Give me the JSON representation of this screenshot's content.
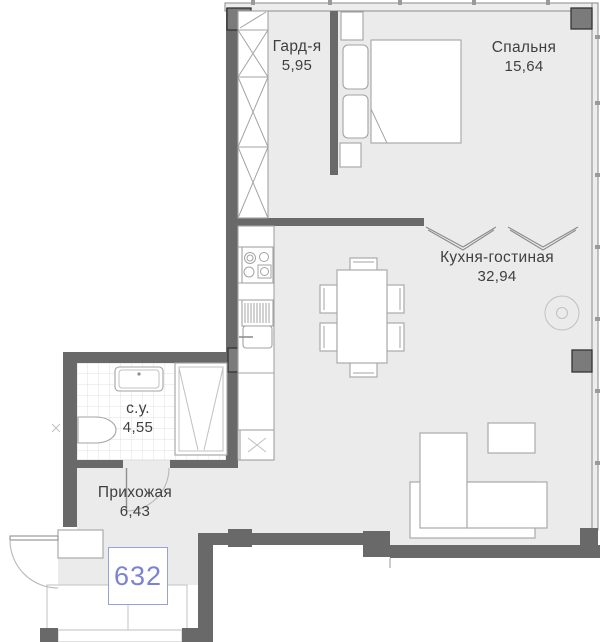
{
  "theme": {
    "floor": "#ebebeb",
    "wall": "#696969",
    "column": "#7b7b7b",
    "line": "#a3a3a3",
    "text": "#3f3f3f",
    "accent": "#7b82cf",
    "badge-border": "#9aa0d8"
  },
  "plan": {
    "unit_number": "632",
    "rooms": [
      {
        "id": "wardrobe",
        "name": "Гард-я",
        "area": "5,95"
      },
      {
        "id": "bedroom",
        "name": "Спальня",
        "area": "15,64"
      },
      {
        "id": "kitchen-living",
        "name": "Кухня-гостиная",
        "area": "32,94"
      },
      {
        "id": "bathroom",
        "name": "с.у.",
        "area": "4,55"
      },
      {
        "id": "hallway",
        "name": "Прихожая",
        "area": "6,43"
      }
    ]
  }
}
